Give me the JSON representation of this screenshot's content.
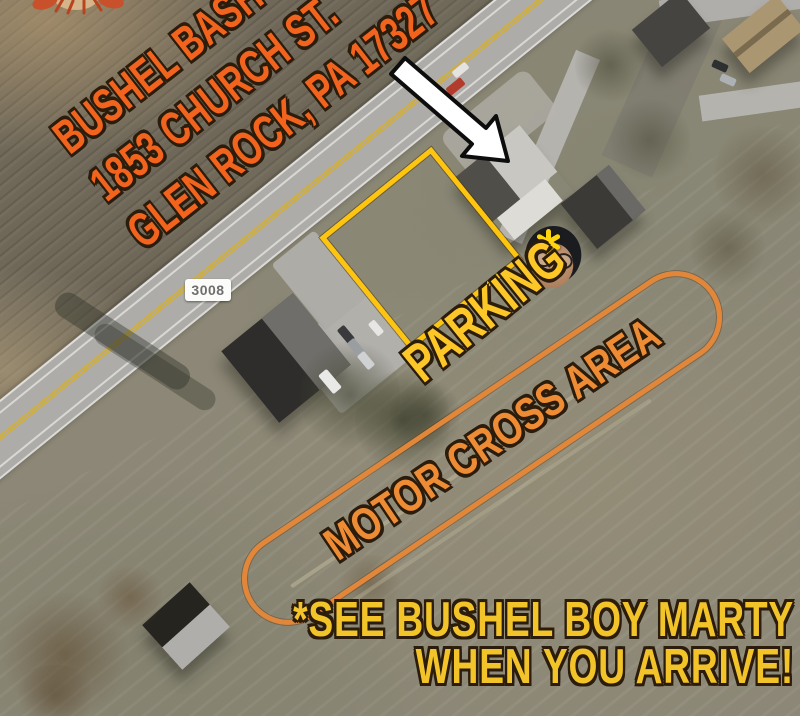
{
  "page": {
    "type": "event-location-satellite-map"
  },
  "header": {
    "event_title": "BUSHEL BASH V",
    "address_line1": "1853 CHURCH ST.",
    "address_line2": "GLEN ROCK, PA 17327"
  },
  "map": {
    "route_sign": "3008",
    "parking_label": "PARKING",
    "motocross_label": "MOTOR CROSS AREA"
  },
  "footer": {
    "note_line1": "*SEE BUSHEL BOY MARTY",
    "note_line2": "WHEN YOU ARRIVE!"
  },
  "icons": {
    "arrow": "white-arrow-pointing-to-venue",
    "asterisk": "yellow-asterisk-marker",
    "face": "bushel-boy-marty-photo",
    "crawfish": "crawfish-graphic-top-edge"
  },
  "colors": {
    "title_orange": "#f2641e",
    "parking_yellow": "#fdc728",
    "motocross_orange": "#ee8c35",
    "note_yellow": "#f2c429",
    "parking_box_yellow": "#fdc410",
    "motocross_box_orange": "#e2873a",
    "route_sign_text": "#6e6e6e",
    "arrow_fill": "#ffffff"
  }
}
